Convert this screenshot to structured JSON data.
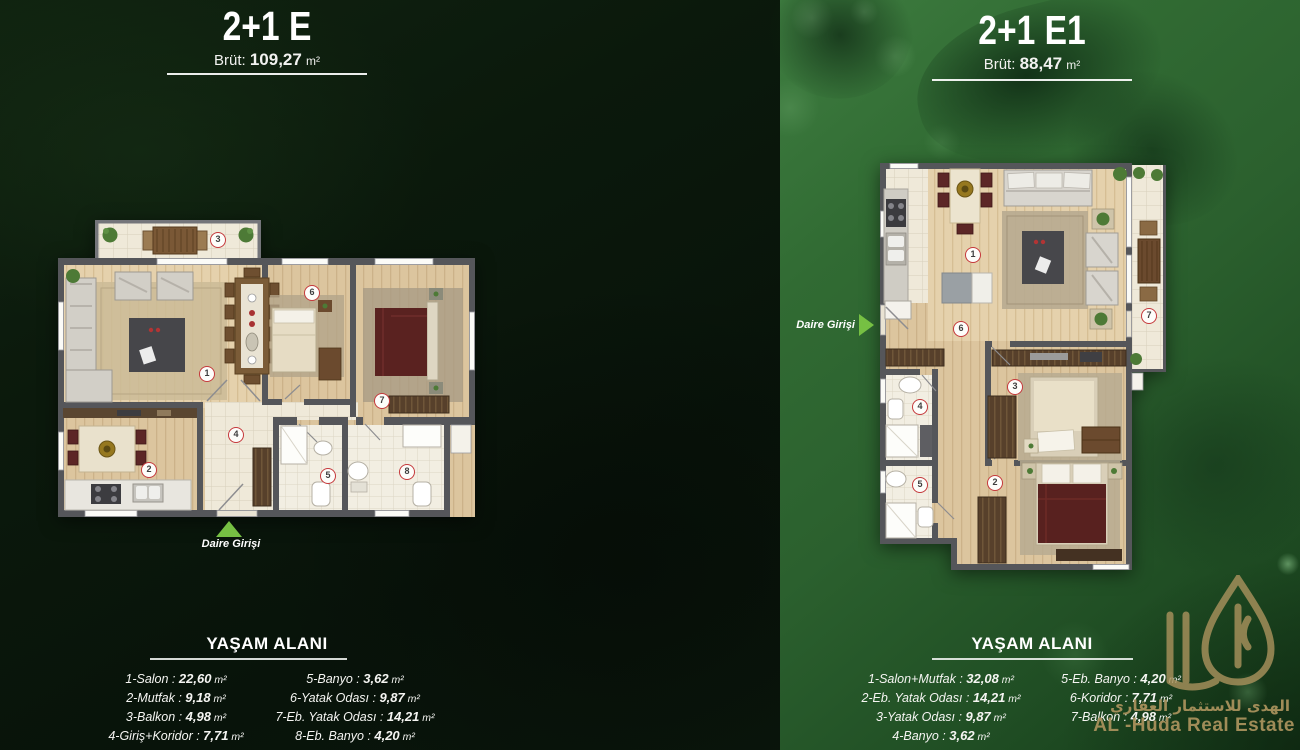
{
  "left_panel": {
    "title": "2+1 E",
    "brut_label": "Brüt:",
    "brut_value": "109,27",
    "brut_unit": "m²",
    "entrance_label": "Daire Girişi",
    "section_heading": "YAŞAM ALANI",
    "markers": [
      "1",
      "2",
      "3",
      "4",
      "5",
      "6",
      "7",
      "8"
    ],
    "rooms_col1": [
      {
        "name": "1-Salon",
        "value": "22,60"
      },
      {
        "name": "2-Mutfak",
        "value": "9,18"
      },
      {
        "name": "3-Balkon",
        "value": "4,98"
      },
      {
        "name": "4-Giriş+Koridor",
        "value": "7,71"
      }
    ],
    "rooms_col2": [
      {
        "name": "5-Banyo",
        "value": "3,62"
      },
      {
        "name": "6-Yatak Odası",
        "value": "9,87"
      },
      {
        "name": "7-Eb. Yatak Odası",
        "value": "14,21"
      },
      {
        "name": "8-Eb. Banyo",
        "value": "4,20"
      }
    ]
  },
  "right_panel": {
    "title": "2+1 E1",
    "brut_label": "Brüt:",
    "brut_value": "88,47",
    "brut_unit": "m²",
    "entrance_label": "Daire Girişi",
    "section_heading": "YAŞAM ALANI",
    "markers": [
      "1",
      "2",
      "3",
      "4",
      "5",
      "6",
      "7"
    ],
    "rooms_col1": [
      {
        "name": "1-Salon+Mutfak",
        "value": "32,08"
      },
      {
        "name": "2-Eb. Yatak Odası",
        "value": "14,21"
      },
      {
        "name": "3-Yatak Odası",
        "value": "9,87"
      },
      {
        "name": "4-Banyo",
        "value": "3,62"
      }
    ],
    "rooms_col2": [
      {
        "name": "5-Eb. Banyo",
        "value": "4,20"
      },
      {
        "name": "6-Koridor",
        "value": "7,71"
      },
      {
        "name": "7-Balkon",
        "value": "4,98"
      }
    ]
  },
  "list_format": {
    "separator": " : ",
    "unit": "m²"
  },
  "watermark": {
    "arabic": "الهدى للاستثمار العقاري",
    "latin": "AL -Huda Real Estate"
  },
  "colors": {
    "accent_green": "#76c043",
    "marker_red": "#c5393c",
    "watermark_gold": "#a8915c",
    "wall_gray": "#55565a",
    "wood": "#ddc69f",
    "tile": "#efe9d9"
  }
}
